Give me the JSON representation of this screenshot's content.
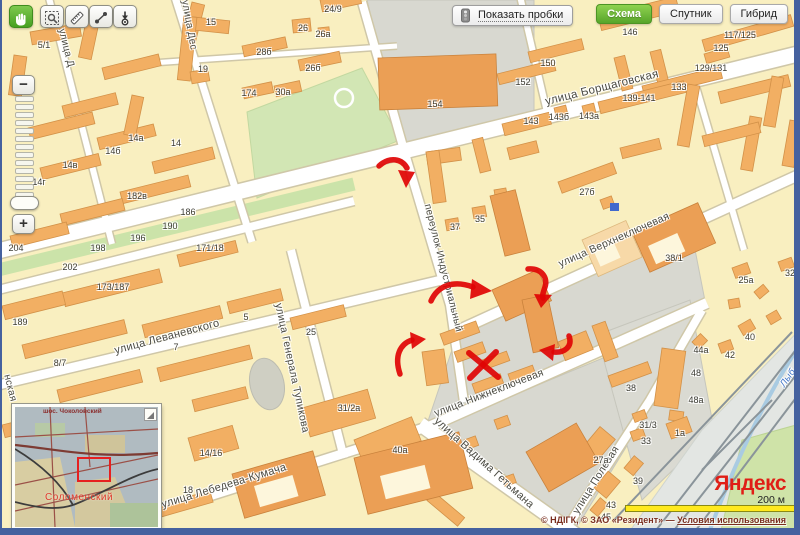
{
  "toolbar": {
    "buttons": [
      "hand-tool-icon",
      "zoom-area-icon",
      "ruler-icon",
      "measure-path-icon",
      "probe-marker-icon"
    ]
  },
  "traffic_button": {
    "label": "Показать пробки",
    "icon": "traffic-light-icon"
  },
  "map_type_switch": {
    "active_color": "#57a52a",
    "options": [
      {
        "label": "Схема",
        "active": true
      },
      {
        "label": "Спутник",
        "active": false
      },
      {
        "label": "Гибрид",
        "active": false
      }
    ]
  },
  "zoom_control": {
    "zoom_out": "−",
    "zoom_in": "+"
  },
  "minimap": {
    "region_label": "Соломенский",
    "top_label": "шос. Чоколовский",
    "viewport_color": "#e62020"
  },
  "branding": {
    "logo": "Яндекс",
    "scale_label": "200 м"
  },
  "attribution": {
    "text": "© НДІГК, © ЗАО «Резидент» — ",
    "link": "Условия использования"
  },
  "map": {
    "streets": [
      {
        "label": "улица Борщаговская",
        "x": 600,
        "y": 88,
        "rot": -14,
        "size": 11.5
      },
      {
        "label": "улица Верхнеключевая",
        "x": 612,
        "y": 240,
        "rot": -24,
        "size": 10.5
      },
      {
        "label": "улица Нижнеключевая",
        "x": 487,
        "y": 393,
        "rot": -21,
        "size": 10.5
      },
      {
        "label": "переулок Индустриальный",
        "x": 441,
        "y": 268,
        "rot": 76,
        "size": 10
      },
      {
        "label": "улица Леваневского",
        "x": 165,
        "y": 337,
        "rot": -15,
        "size": 11
      },
      {
        "label": "улица Генерала Тупикова",
        "x": 290,
        "y": 368,
        "rot": 78,
        "size": 10.5
      },
      {
        "label": "улица Лебедева-Кумача",
        "x": 222,
        "y": 486,
        "rot": -17,
        "size": 11
      },
      {
        "label": "улица Вадима Гетьмана",
        "x": 482,
        "y": 463,
        "rot": 42,
        "size": 11
      },
      {
        "label": "улица Полевая",
        "x": 594,
        "y": 480,
        "rot": -58,
        "size": 10.5
      },
      {
        "label": "улица Дес",
        "x": 187,
        "y": 25,
        "rot": 80,
        "size": 10
      },
      {
        "label": "улица Д",
        "x": 64,
        "y": 48,
        "rot": 76,
        "size": 10
      },
      {
        "label": "нская",
        "x": 8,
        "y": 388,
        "rot": 76,
        "size": 10
      },
      {
        "label": "Лыб",
        "x": 786,
        "y": 378,
        "rot": -55,
        "size": 9.5,
        "color": "#3f74c8",
        "italic": true
      }
    ],
    "numbers": [
      {
        "t": "5/1",
        "x": 42,
        "y": 45
      },
      {
        "t": "15",
        "x": 209,
        "y": 22
      },
      {
        "t": "24/9",
        "x": 331,
        "y": 9
      },
      {
        "t": "26",
        "x": 301,
        "y": 28
      },
      {
        "t": "26а",
        "x": 321,
        "y": 34
      },
      {
        "t": "28б",
        "x": 262,
        "y": 52
      },
      {
        "t": "19",
        "x": 201,
        "y": 69
      },
      {
        "t": "26б",
        "x": 311,
        "y": 68
      },
      {
        "t": "174",
        "x": 247,
        "y": 93
      },
      {
        "t": "30а",
        "x": 281,
        "y": 92
      },
      {
        "t": "146",
        "x": 628,
        "y": 32
      },
      {
        "t": "117/125",
        "x": 738,
        "y": 35
      },
      {
        "t": "125",
        "x": 719,
        "y": 48
      },
      {
        "t": "129/131",
        "x": 709,
        "y": 68
      },
      {
        "t": "133",
        "x": 677,
        "y": 87
      },
      {
        "t": "139-141",
        "x": 637,
        "y": 98
      },
      {
        "t": "150",
        "x": 546,
        "y": 63
      },
      {
        "t": "152",
        "x": 521,
        "y": 82
      },
      {
        "t": "154",
        "x": 433,
        "y": 104
      },
      {
        "t": "143",
        "x": 529,
        "y": 121
      },
      {
        "t": "143б",
        "x": 557,
        "y": 117
      },
      {
        "t": "143а",
        "x": 587,
        "y": 116
      },
      {
        "t": "14а",
        "x": 134,
        "y": 138
      },
      {
        "t": "14",
        "x": 174,
        "y": 143
      },
      {
        "t": "14б",
        "x": 111,
        "y": 151
      },
      {
        "t": "14в",
        "x": 68,
        "y": 165
      },
      {
        "t": "14г",
        "x": 37,
        "y": 182
      },
      {
        "t": "182в",
        "x": 135,
        "y": 196
      },
      {
        "t": "186",
        "x": 186,
        "y": 212
      },
      {
        "t": "190",
        "x": 168,
        "y": 226
      },
      {
        "t": "196",
        "x": 136,
        "y": 238
      },
      {
        "t": "198",
        "x": 96,
        "y": 248
      },
      {
        "t": "202",
        "x": 68,
        "y": 267
      },
      {
        "t": "204",
        "x": 14,
        "y": 248
      },
      {
        "t": "171/18",
        "x": 208,
        "y": 248
      },
      {
        "t": "173/187",
        "x": 111,
        "y": 287
      },
      {
        "t": "189",
        "x": 18,
        "y": 322
      },
      {
        "t": "8/7",
        "x": 58,
        "y": 363
      },
      {
        "t": "7",
        "x": 174,
        "y": 347
      },
      {
        "t": "5",
        "x": 244,
        "y": 317
      },
      {
        "t": "25",
        "x": 309,
        "y": 332
      },
      {
        "t": "31/2а",
        "x": 347,
        "y": 408
      },
      {
        "t": "37",
        "x": 453,
        "y": 227
      },
      {
        "t": "35",
        "x": 478,
        "y": 219
      },
      {
        "t": "27б",
        "x": 585,
        "y": 192
      },
      {
        "t": "38/1",
        "x": 672,
        "y": 258
      },
      {
        "t": "25а",
        "x": 744,
        "y": 280
      },
      {
        "t": "32",
        "x": 788,
        "y": 273
      },
      {
        "t": "40",
        "x": 748,
        "y": 337
      },
      {
        "t": "44а",
        "x": 699,
        "y": 350
      },
      {
        "t": "42",
        "x": 728,
        "y": 355
      },
      {
        "t": "48",
        "x": 694,
        "y": 373
      },
      {
        "t": "48а",
        "x": 694,
        "y": 400
      },
      {
        "t": "38",
        "x": 629,
        "y": 388
      },
      {
        "t": "31/3",
        "x": 646,
        "y": 425
      },
      {
        "t": "33",
        "x": 644,
        "y": 441
      },
      {
        "t": "1а",
        "x": 678,
        "y": 433
      },
      {
        "t": "27а",
        "x": 599,
        "y": 460
      },
      {
        "t": "39",
        "x": 636,
        "y": 481
      },
      {
        "t": "43",
        "x": 609,
        "y": 505
      },
      {
        "t": "45",
        "x": 604,
        "y": 517
      },
      {
        "t": "14/16",
        "x": 209,
        "y": 453
      },
      {
        "t": "18",
        "x": 186,
        "y": 490
      },
      {
        "t": "40а",
        "x": 398,
        "y": 450
      }
    ],
    "ink": {
      "color": "#e00404",
      "arrows": [
        {
          "tail": "M 377,166 C 388,156 400,159 405,168",
          "head": "M 396,170 L 413,172 L 404,188 Z"
        },
        {
          "tail": "M 429,301 C 436,285 452,280 471,287",
          "head": "M 470,279 L 490,291 L 468,299 Z"
        },
        {
          "tail": "M 526,269 C 540,268 546,278 543,287 C 541,293 540,296 541,298",
          "head": "M 532,294 L 550,295 L 539,308 Z"
        },
        {
          "tail": "M 567,336 C 571,347 562,353 552,352",
          "head": "M 553,344 L 551,361 L 537,350 Z"
        },
        {
          "tail": "M 398,374 C 392,356 398,344 410,340",
          "head": "M 408,332 L 424,339 L 410,349 Z"
        }
      ],
      "cross": [
        "M 467,353 L 496,377",
        "M 494,352 L 468,378"
      ]
    }
  }
}
